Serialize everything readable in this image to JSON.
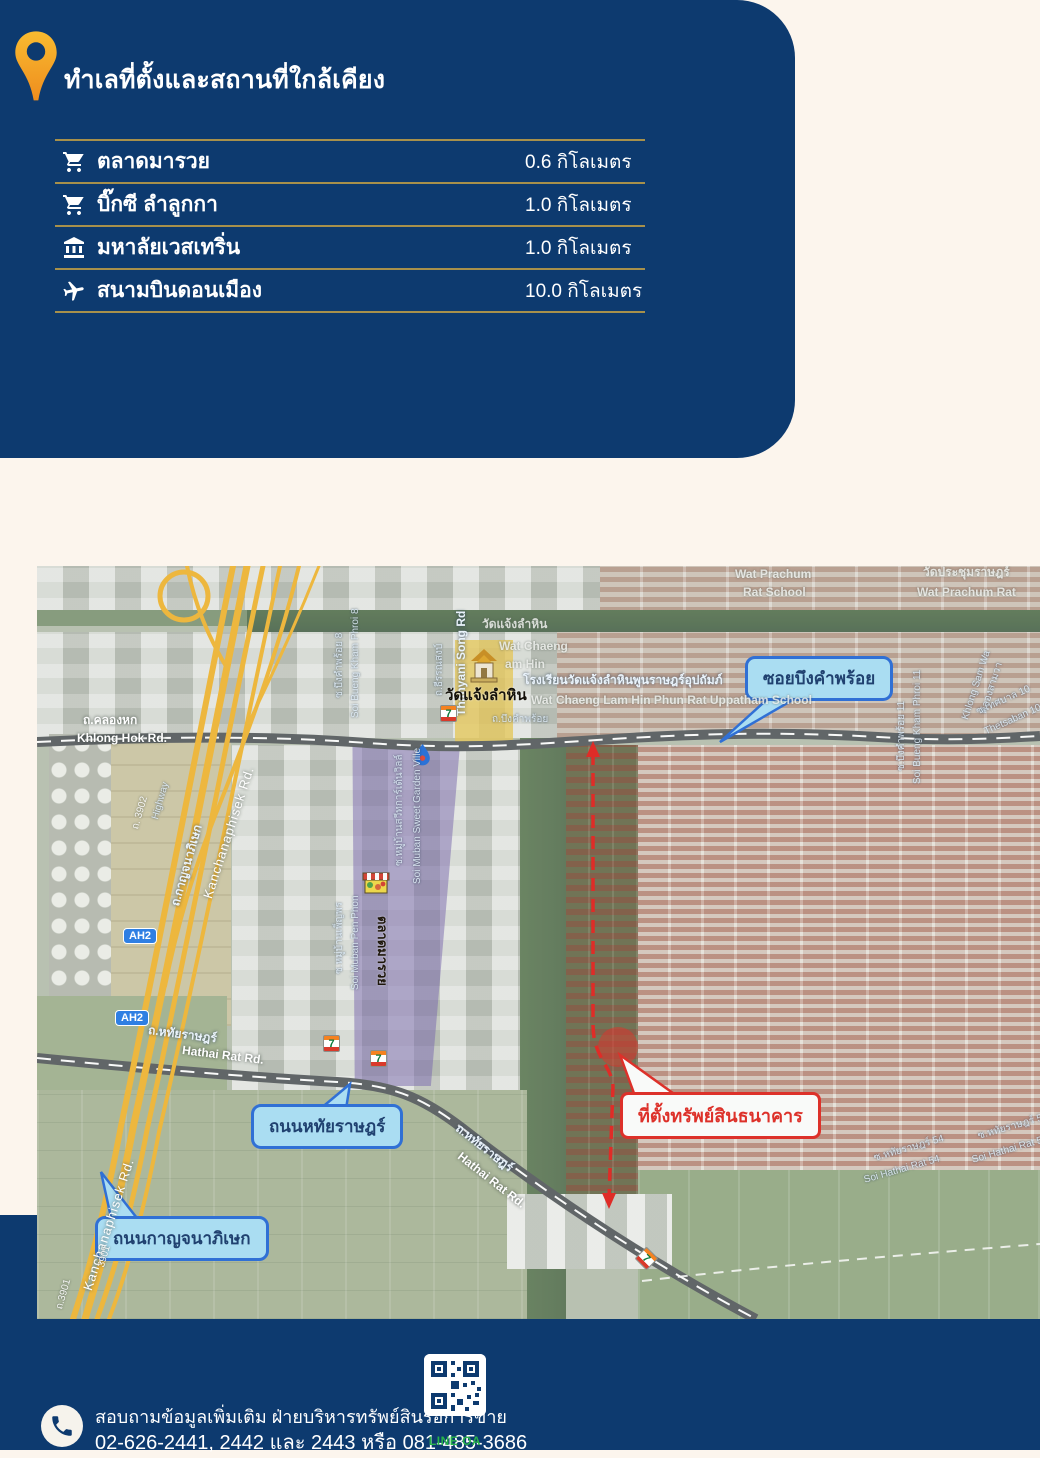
{
  "colors": {
    "navy": "#0d3a6f",
    "cream": "#fcf5ed",
    "gold_line": "#a7904b",
    "pin_orange": "#f5a623",
    "callout_bg": "#a5def7",
    "callout_border": "#1b62d6",
    "alert_red": "#e01b14",
    "highway_yellow": "#f2b32b",
    "line_oa_green": "#27b34a"
  },
  "header": {
    "title": "ทำเลที่ตั้งและสถานที่ใกล้เคียง"
  },
  "poi_table": {
    "rows": [
      {
        "icon": "cart-icon",
        "name": "ตลาดมารวย",
        "distance": "0.6 กิโลเมตร"
      },
      {
        "icon": "cart-icon",
        "name": "บิ๊กซี ลำลูกกา",
        "distance": "1.0 กิโลเมตร"
      },
      {
        "icon": "university-icon",
        "name": "มหาลัยเวสเทริ่น",
        "distance": "1.0 กิโลเมตร"
      },
      {
        "icon": "plane-icon",
        "name": "สนามบินดอนเมือง",
        "distance": "10.0 กิโลเมตร"
      }
    ]
  },
  "map": {
    "callouts": {
      "soi_bueng": {
        "label": "ซอยบึงคำพร้อย"
      },
      "hathai": {
        "label": "ถนนหทัยราษฎร์"
      },
      "kanchana": {
        "label": "ถนนกาญจนาภิเษก"
      },
      "property": {
        "label": "ที่ตั้งทรัพย์สินธนาคาร"
      }
    },
    "shields": [
      {
        "label": "AH2",
        "x": 86,
        "y": 362
      },
      {
        "label": "AH2",
        "x": 78,
        "y": 444
      }
    ],
    "seven_glyph": "7",
    "stores_711": [
      {
        "x": 403,
        "y": 139,
        "r": 0
      },
      {
        "x": 286,
        "y": 469,
        "r": 0
      },
      {
        "x": 333,
        "y": 484,
        "r": 0
      },
      {
        "x": 601,
        "y": 684,
        "r": 45
      }
    ],
    "labels": [
      {
        "t": "ถ.คลองหก",
        "x": 46,
        "y": 148,
        "r": 0,
        "c": "wl2"
      },
      {
        "t": "Khlong Hok Rd.",
        "x": 40,
        "y": 166,
        "r": 0,
        "c": "wl2"
      },
      {
        "t": "ถ.บึงคำพร้อย",
        "x": 455,
        "y": 149,
        "r": 0,
        "c": "bl"
      },
      {
        "t": "วัดแจ้งลำหิน",
        "x": 445,
        "y": 52,
        "r": 0,
        "c": "gl"
      },
      {
        "t": "Wat Chaeng",
        "x": 462,
        "y": 74,
        "r": 0,
        "c": "gl"
      },
      {
        "t": "am Hin",
        "x": 468,
        "y": 92,
        "r": 0,
        "c": "gl"
      },
      {
        "t": "โรงเรียนวัดแจ้งลำหินพูนราษฎร์อุปถัมภ์",
        "x": 486,
        "y": 108,
        "r": 0,
        "c": "bl2"
      },
      {
        "t": "Wat Chaeng Lam Hin Phun Rat Uppatham School",
        "x": 494,
        "y": 128,
        "r": 0,
        "c": "gl"
      },
      {
        "t": "Wat Prachum",
        "x": 698,
        "y": 2,
        "r": 0,
        "c": "gl"
      },
      {
        "t": "Rat School",
        "x": 706,
        "y": 20,
        "r": 0,
        "c": "gl"
      },
      {
        "t": "วัดประชุมราษฎร์",
        "x": 886,
        "y": 0,
        "r": 0,
        "c": "gl"
      },
      {
        "t": "Wat Prachum Rat",
        "x": 880,
        "y": 20,
        "r": 0,
        "c": "gl"
      },
      {
        "t": "ถ.ธีรรณสงบ์",
        "x": 398,
        "y": 130,
        "r": -90,
        "c": "bl"
      },
      {
        "t": "Thanyani Song Rd",
        "x": 418,
        "y": 150,
        "r": -90,
        "c": "bl2"
      },
      {
        "t": "ซ.บึงคำพร้อย 8",
        "x": 298,
        "y": 132,
        "r": -90,
        "c": "bl"
      },
      {
        "t": "Soi Bueng Kham Phroi 8",
        "x": 314,
        "y": 152,
        "r": -90,
        "c": "bl"
      },
      {
        "t": "ซ.บึงคำพร้อย 11",
        "x": 860,
        "y": 205,
        "r": -90,
        "c": "bl"
      },
      {
        "t": "Soi Bueng Kham Phroi 11",
        "x": 876,
        "y": 218,
        "r": -90,
        "c": "bl"
      },
      {
        "t": "คลองสามวา",
        "x": 942,
        "y": 146,
        "r": -72,
        "c": "bl"
      },
      {
        "t": "Khlong Sam Wa",
        "x": 924,
        "y": 152,
        "r": -72,
        "c": "bl"
      },
      {
        "t": "ซ.เทศบาล 10",
        "x": 938,
        "y": 142,
        "r": -24,
        "c": "bl"
      },
      {
        "t": "Thetsaban 10",
        "x": 946,
        "y": 162,
        "r": -24,
        "c": "bl"
      },
      {
        "t": "ซ.หมู่บ้านสวีทการ์เด้นวิลล์",
        "x": 358,
        "y": 300,
        "r": -90,
        "c": "bl"
      },
      {
        "t": "Soi Muban Sweet Garden Ville",
        "x": 376,
        "y": 318,
        "r": -90,
        "c": "bl"
      },
      {
        "t": "ซ.หมู่บ้านเพ็ญพร",
        "x": 298,
        "y": 408,
        "r": -90,
        "c": "bl"
      },
      {
        "t": "Soi Muban Pen Phon",
        "x": 314,
        "y": 424,
        "r": -90,
        "c": "bl"
      },
      {
        "t": "ถ.หทัยราษฎร์",
        "x": 112,
        "y": 458,
        "r": 7,
        "c": "bl2"
      },
      {
        "t": "Hathai Rat Rd.",
        "x": 146,
        "y": 478,
        "r": 7,
        "c": "wl2"
      },
      {
        "t": "ถ.หทัยราษฎร์",
        "x": 424,
        "y": 556,
        "r": 38,
        "c": "bl2"
      },
      {
        "t": "Hathai Rat Rd.",
        "x": 426,
        "y": 584,
        "r": 38,
        "c": "wl2"
      },
      {
        "t": "ซ.หทัยราษฎร์ 54",
        "x": 836,
        "y": 588,
        "r": -16,
        "c": "bl"
      },
      {
        "t": "Soi Hathai Rat 54",
        "x": 826,
        "y": 610,
        "r": -16,
        "c": "bl"
      },
      {
        "t": "ซ.หทัยราษฎร์ 54",
        "x": 940,
        "y": 566,
        "r": -16,
        "c": "bl"
      },
      {
        "t": "Soi Hathai Rat 54",
        "x": 934,
        "y": 590,
        "r": -16,
        "c": "bl"
      },
      {
        "t": "ถ. 3902",
        "x": 94,
        "y": 262,
        "r": -74,
        "c": "wl"
      },
      {
        "t": "Highway",
        "x": 114,
        "y": 252,
        "r": -74,
        "c": "bl"
      },
      {
        "t": "ถ.กาญจนาภิเษก",
        "x": 132,
        "y": 338,
        "r": -74,
        "c": "bl2"
      },
      {
        "t": "Kanchanaphisek Rd.",
        "x": 164,
        "y": 330,
        "r": -72,
        "c": "wl3"
      },
      {
        "t": "Kanchanaphisek Rd.",
        "x": 44,
        "y": 722,
        "r": -72,
        "c": "wl3"
      },
      {
        "t": "3901",
        "x": 60,
        "y": 700,
        "r": -74,
        "c": "wl"
      },
      {
        "t": "ถ.3901",
        "x": 18,
        "y": 742,
        "r": -74,
        "c": "wl"
      },
      {
        "t": "ตลาดมารวย",
        "x": 352,
        "y": 350,
        "r": 90,
        "c": "kl2"
      },
      {
        "t": "วัดแจ้งลำหิน",
        "x": 408,
        "y": 122,
        "r": 0,
        "c": "kl"
      }
    ]
  },
  "footer": {
    "line1": "สอบถามข้อมูลเพิ่มเติม ฝ่ายบริหารทรัพย์สินรอการขาย",
    "line2": "02-626-2441, 2442 และ 2443 หรือ 081-485-3686",
    "qr_label": "LINE OA"
  }
}
